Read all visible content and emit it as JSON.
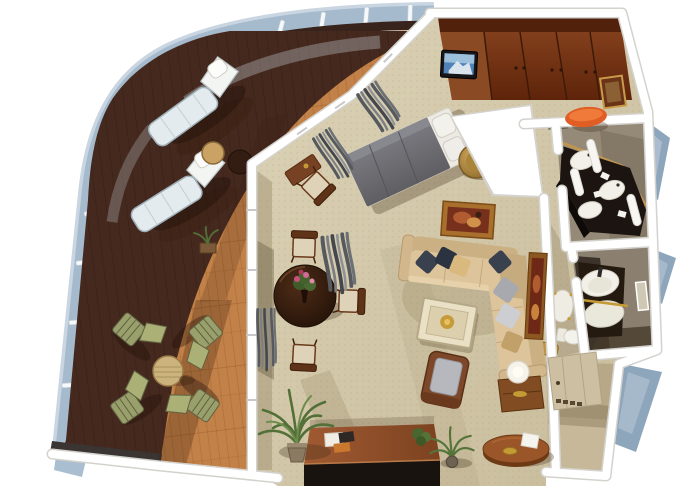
{
  "scene": {
    "type": "isometric-floorplan-render",
    "description": "3D cutaway floor plan of a cruise ship suite with a curved wraparound teak veranda, living-dining room, bedroom, master bathroom, guest bathroom and entry hall",
    "rooms": [
      {
        "name": "veranda",
        "furniture": [
          "sun lounger",
          "sun lounger",
          "round side table",
          "dark side table",
          "deck dining table",
          "folding deck chair",
          "folding deck chair",
          "folding deck chair",
          "folding deck chair",
          "planter"
        ]
      },
      {
        "name": "living-dining-room",
        "furniture": [
          "round dining table with flower bouquet",
          "dining chair",
          "dining chair",
          "dining chair",
          "writing desk with chair",
          "L-shaped sectional sofa",
          "throw pillows",
          "coffee table with gold bowl",
          "armchair",
          "side table with lamp",
          "landscape painting",
          "tall painting",
          "console table with books",
          "potted palm",
          "potted plant",
          "gray curtains"
        ]
      },
      {
        "name": "bedroom",
        "furniture": [
          "wood wardrobe wall",
          "wall-mounted tv",
          "double bed with gray duvet",
          "round gold chair",
          "vanity mirror",
          "orange bench",
          "curtains"
        ]
      },
      {
        "name": "master-bathroom",
        "furniture": [
          "dark double-sink vanity",
          "white basin",
          "white basin",
          "white basin",
          "towel columns",
          "wood counter trim"
        ]
      },
      {
        "name": "guest-bathroom",
        "furniture": [
          "white washbasin",
          "gold towel bar",
          "toilet",
          "wall mirror"
        ]
      },
      {
        "name": "hallway",
        "furniture": [
          "white stool",
          "gold bench",
          "dark doormat"
        ]
      },
      {
        "name": "entry-hall",
        "furniture": [
          "cabin door",
          "demilune table with card and gold dish"
        ]
      }
    ],
    "palette": {
      "bg": "#ffffff",
      "seaWedge": "#8ea6bc",
      "seaWedgeLight": "#b6c6d4",
      "hullGlass": "#a6bacd",
      "hullGlassLight": "#c9d6e2",
      "hullPost": "#f6f9fb",
      "railing": "#38241c",
      "deckDark": "#45291e",
      "deckLight": "#c28148",
      "charcoalRim": "#3a3433",
      "wall": "#ffffff",
      "wallEdge": "#d4d2cd",
      "wallFace": "#b3a78f",
      "carpet": "#d3c8a9",
      "closetWood": "#7b3a1a",
      "closetWoodDark": "#4e200c",
      "closetWoodLight": "#8a4a24",
      "tvScreen": "#4f82b8",
      "bedDuvet": "#6d6d72",
      "bedLinen": "#eceae2",
      "goldChair": "#b5893c",
      "orangeSeat": "#e05e24",
      "sofaSeat": "#ddc49b",
      "sofaBack": "#cbb083",
      "pillowNavy": "#39404e",
      "pillowTan": "#d9b97e",
      "pillowGray": "#a8a9af",
      "diningTable": "#3a2114",
      "chairSeat": "#ded3b8",
      "curtain": "#63666b",
      "plantGreen": "#527038",
      "paintFrame": "#a8702c",
      "paintCanvas": "#77301c",
      "vanityDark": "#1c1410",
      "sinkWhite": "#f2f0e8",
      "bathFloor": "#958a77",
      "bath2Floor": "#8b8070",
      "entryFloor": "#c6b898",
      "doorBeige": "#cdbfa2",
      "consoleTop": "#a05a32",
      "consoleFront": "#191310",
      "accentGold": "#c49a34",
      "lampShade": "#f5f3ea",
      "flowerPink": "#c8507e"
    }
  }
}
